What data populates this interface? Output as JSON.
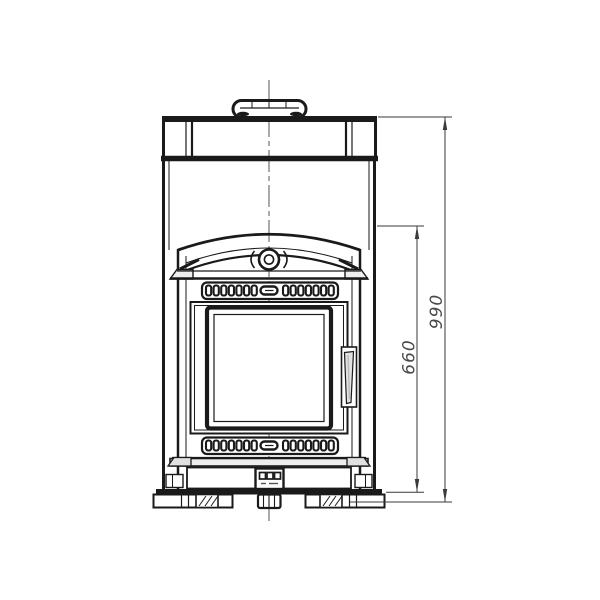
{
  "drawing": {
    "style": {
      "background_color": "#ffffff",
      "ink_color": "#1a1a1a",
      "dimension_line_color": "#3a3a3a",
      "dimension_text_color": "#4a4a4a"
    },
    "dimensions": {
      "overall_height": {
        "label": "990"
      },
      "door_unit_height": {
        "label": "660"
      }
    }
  }
}
